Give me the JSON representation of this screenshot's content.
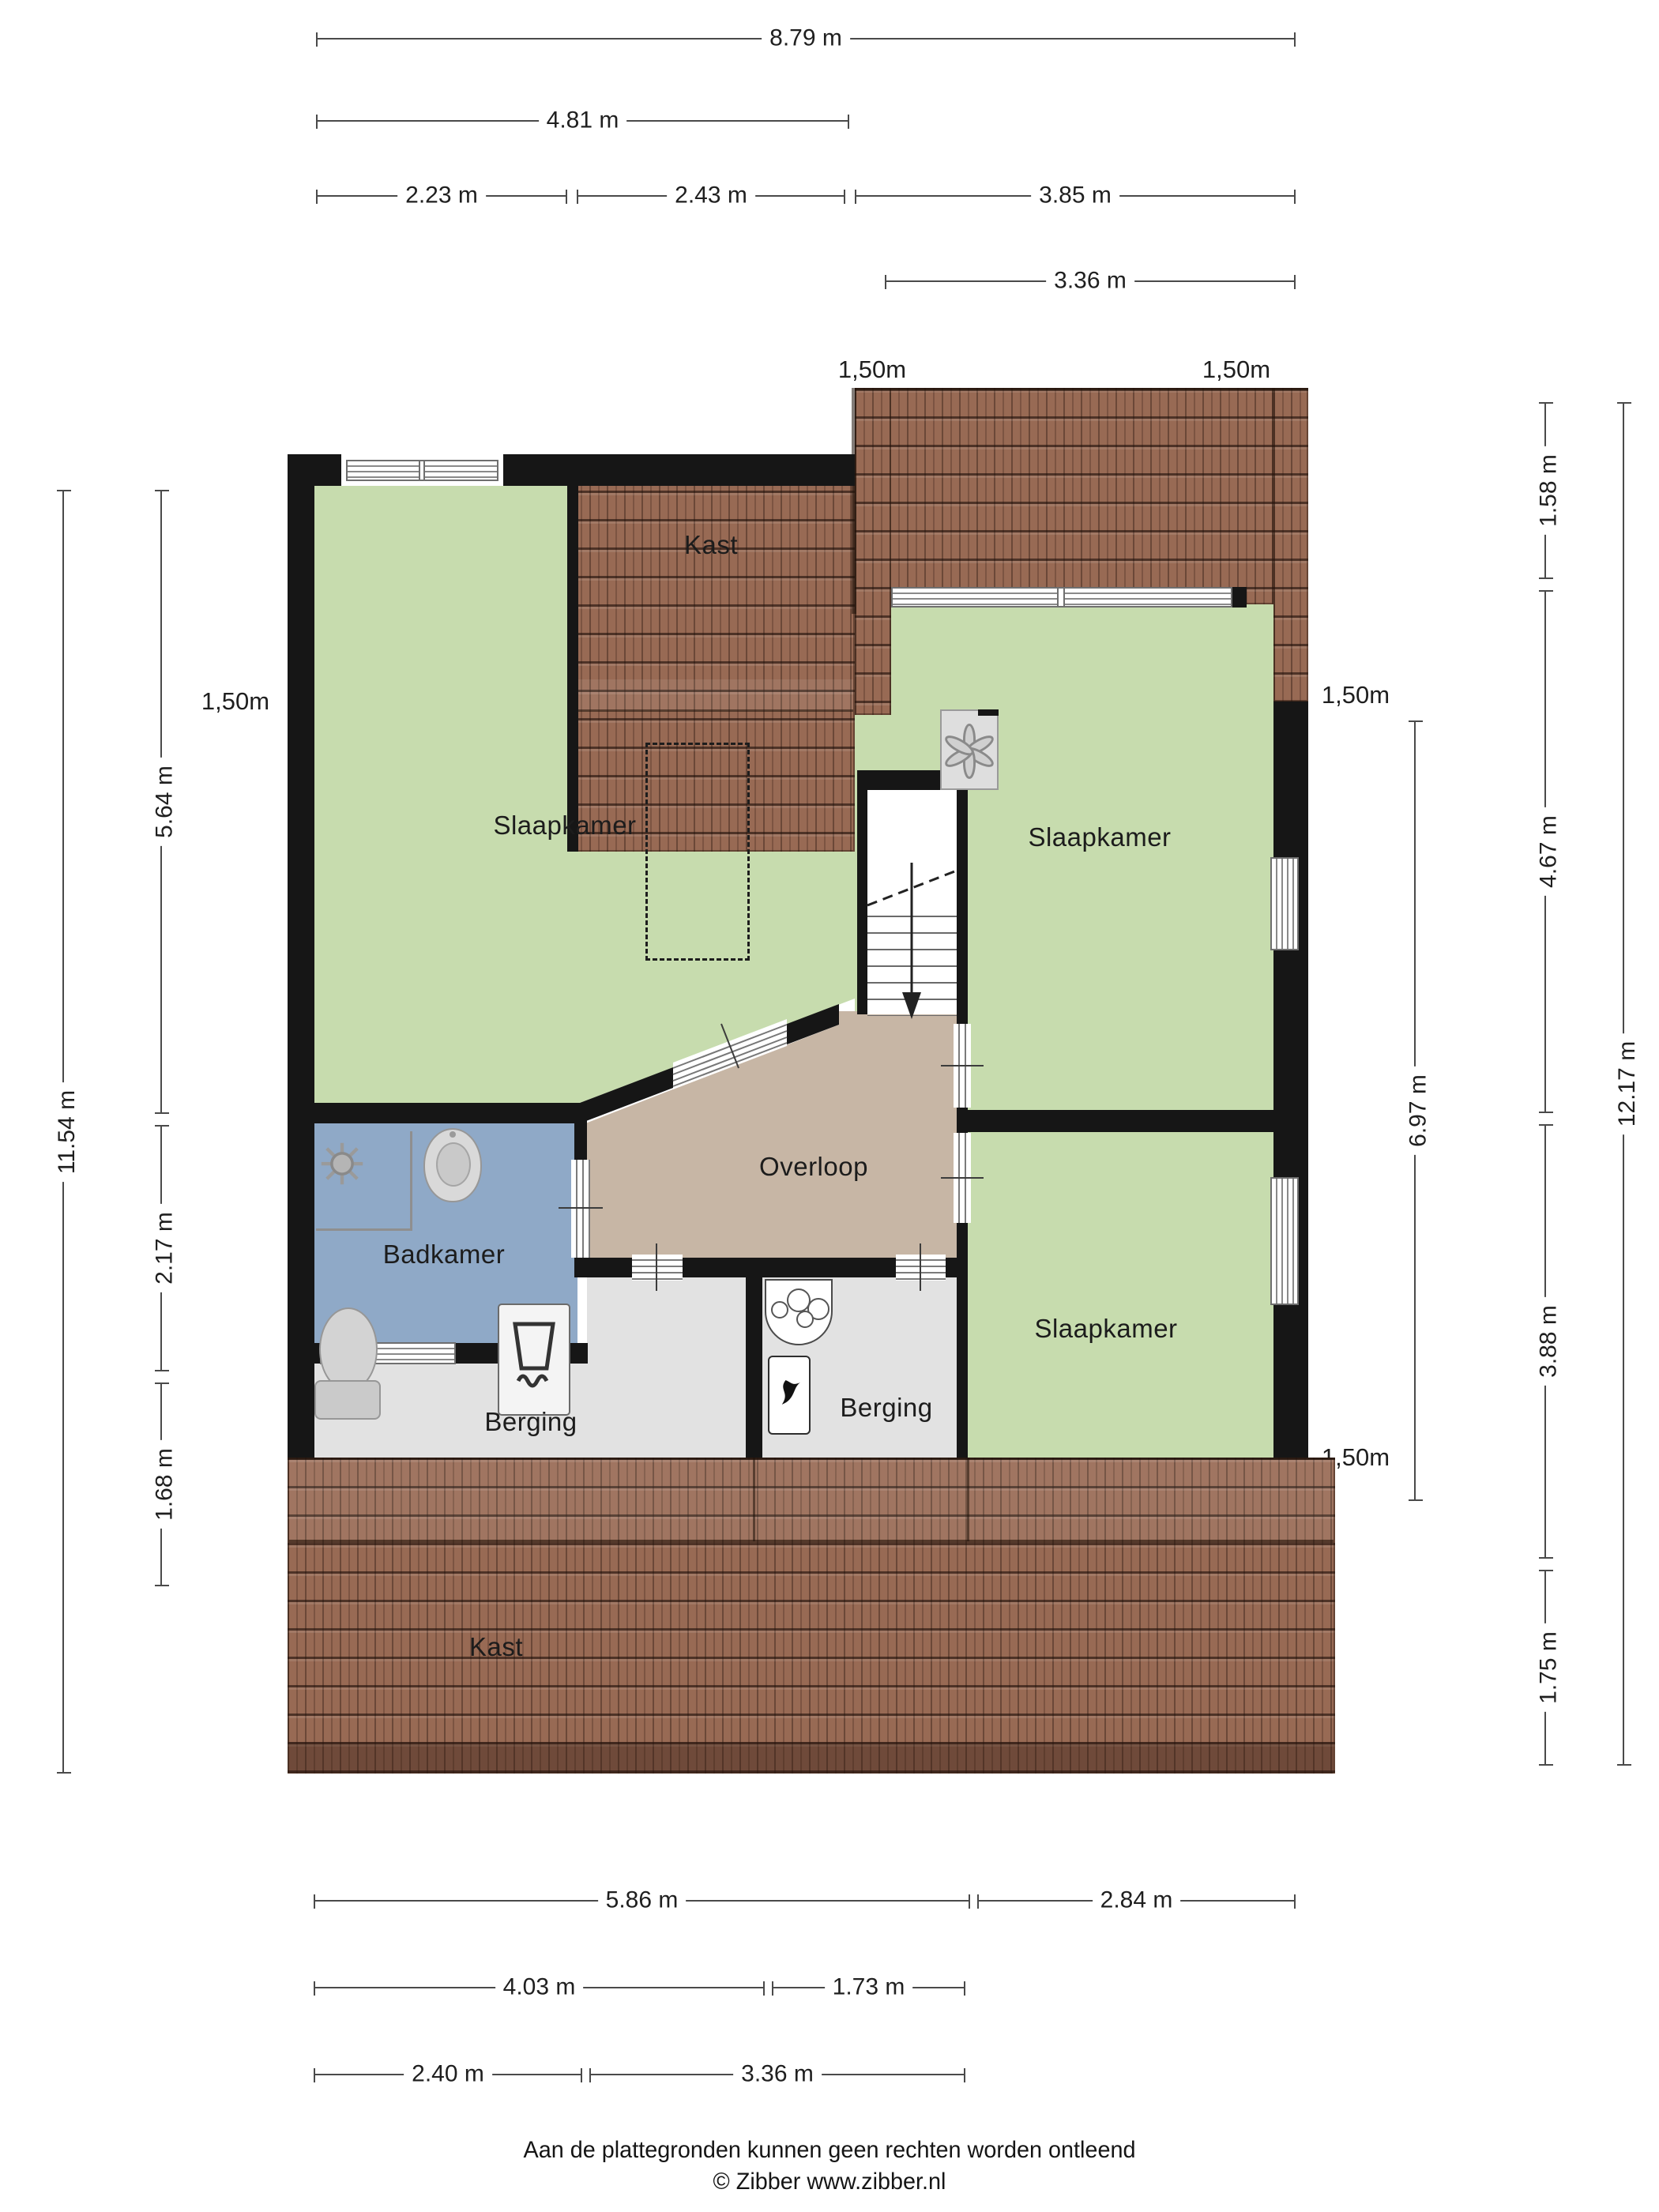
{
  "colors": {
    "green": "#c7dcae",
    "tan": "#c7b6a5",
    "blue": "#8fa9c7",
    "gray": "#e2e2e2",
    "roof": "#986a54",
    "wall": "#161616",
    "dimline": "#4a4a4a",
    "dimtext": "#1f1f1f",
    "labeltext": "#1c1c1c"
  },
  "rooms": {
    "kast_top": "Kast",
    "slaapkamer_left": "Slaapkamer",
    "slaapkamer_right_top": "Slaapkamer",
    "slaapkamer_right_bottom": "Slaapkamer",
    "badkamer": "Badkamer",
    "overloop": "Overloop",
    "berging_left": "Berging",
    "berging_right": "Berging",
    "kast_bottom": "Kast"
  },
  "dimensions": {
    "knee_label": "1,50m",
    "top": {
      "w_total": "8.79 m",
      "w_left": "4.81 m",
      "w_a": "2.23 m",
      "w_b": "2.43 m",
      "w_c": "3.85 m",
      "w_dormer": "3.36 m"
    },
    "bottom": {
      "r1a": "5.86 m",
      "r1b": "2.84 m",
      "r2a": "4.03 m",
      "r2b": "1.73 m",
      "r3a": "2.40 m",
      "r3b": "3.36 m"
    },
    "left": {
      "total": "11.54 m",
      "a": "5.64 m",
      "b": "2.17 m",
      "c": "1.68 m"
    },
    "right": {
      "a": "1.58 m",
      "b": "4.67 m",
      "mid": "6.97 m",
      "total": "12.17 m",
      "c": "3.88 m",
      "d": "1.75 m"
    }
  },
  "footer": {
    "line1": "Aan de plattegronden kunnen geen rechten worden ontleend",
    "line2": "© Zibber www.zibber.nl"
  }
}
